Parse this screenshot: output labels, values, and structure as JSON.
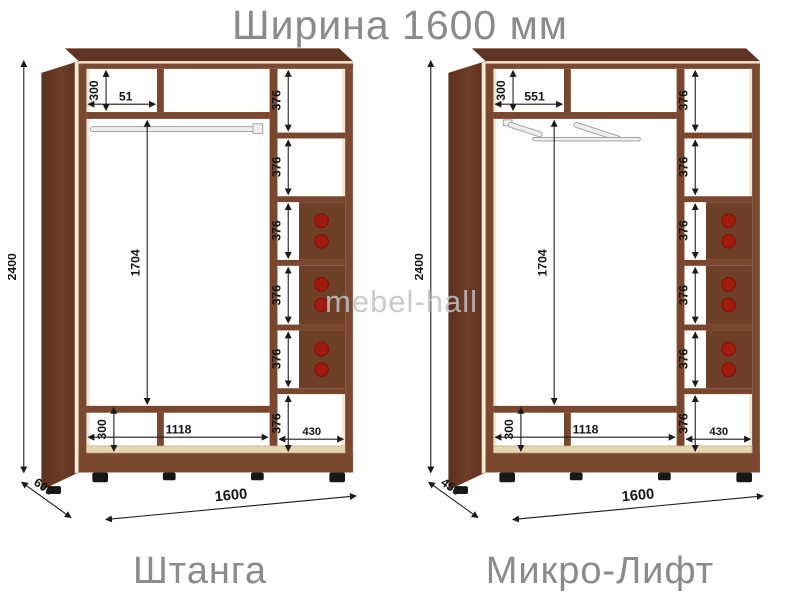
{
  "title": "Ширина 1600 мм",
  "watermark": "mebel-hall",
  "colors": {
    "wood_side": "#6a3a24",
    "wood_front": "#7c4930",
    "wood_shelf": "#7a462e",
    "wood_drawer": "#6f4028",
    "edge_highlight": "#f1e8cf",
    "handle_dot_red": "#a11c0e",
    "dimension_line": "#1b1b1b",
    "heading_gray": "#8b8b8b",
    "watermark_gray": "#c3c3c3"
  },
  "wardrobes": [
    {
      "name": "Штанга",
      "feature": "hanging-rod",
      "dims": {
        "height": "2400",
        "width": "1600",
        "depth": "600",
        "top_section_height": "300",
        "top_left_width": "51",
        "hanging_height": "1704",
        "bottom_section_height": "300",
        "main_width": "1118",
        "shelf_column_width": "430",
        "shelf_heights": [
          "376",
          "376",
          "376",
          "376",
          "376",
          "376"
        ]
      }
    },
    {
      "name": "Микро-Лифт",
      "feature": "micro-lift",
      "dims": {
        "height": "2400",
        "width": "1600",
        "depth": "450",
        "top_section_height": "300",
        "top_left_width": "551",
        "hanging_height": "1704",
        "bottom_section_height": "300",
        "main_width": "1118",
        "shelf_column_width": "430",
        "shelf_heights": [
          "376",
          "376",
          "376",
          "376",
          "376",
          "376"
        ]
      }
    }
  ]
}
